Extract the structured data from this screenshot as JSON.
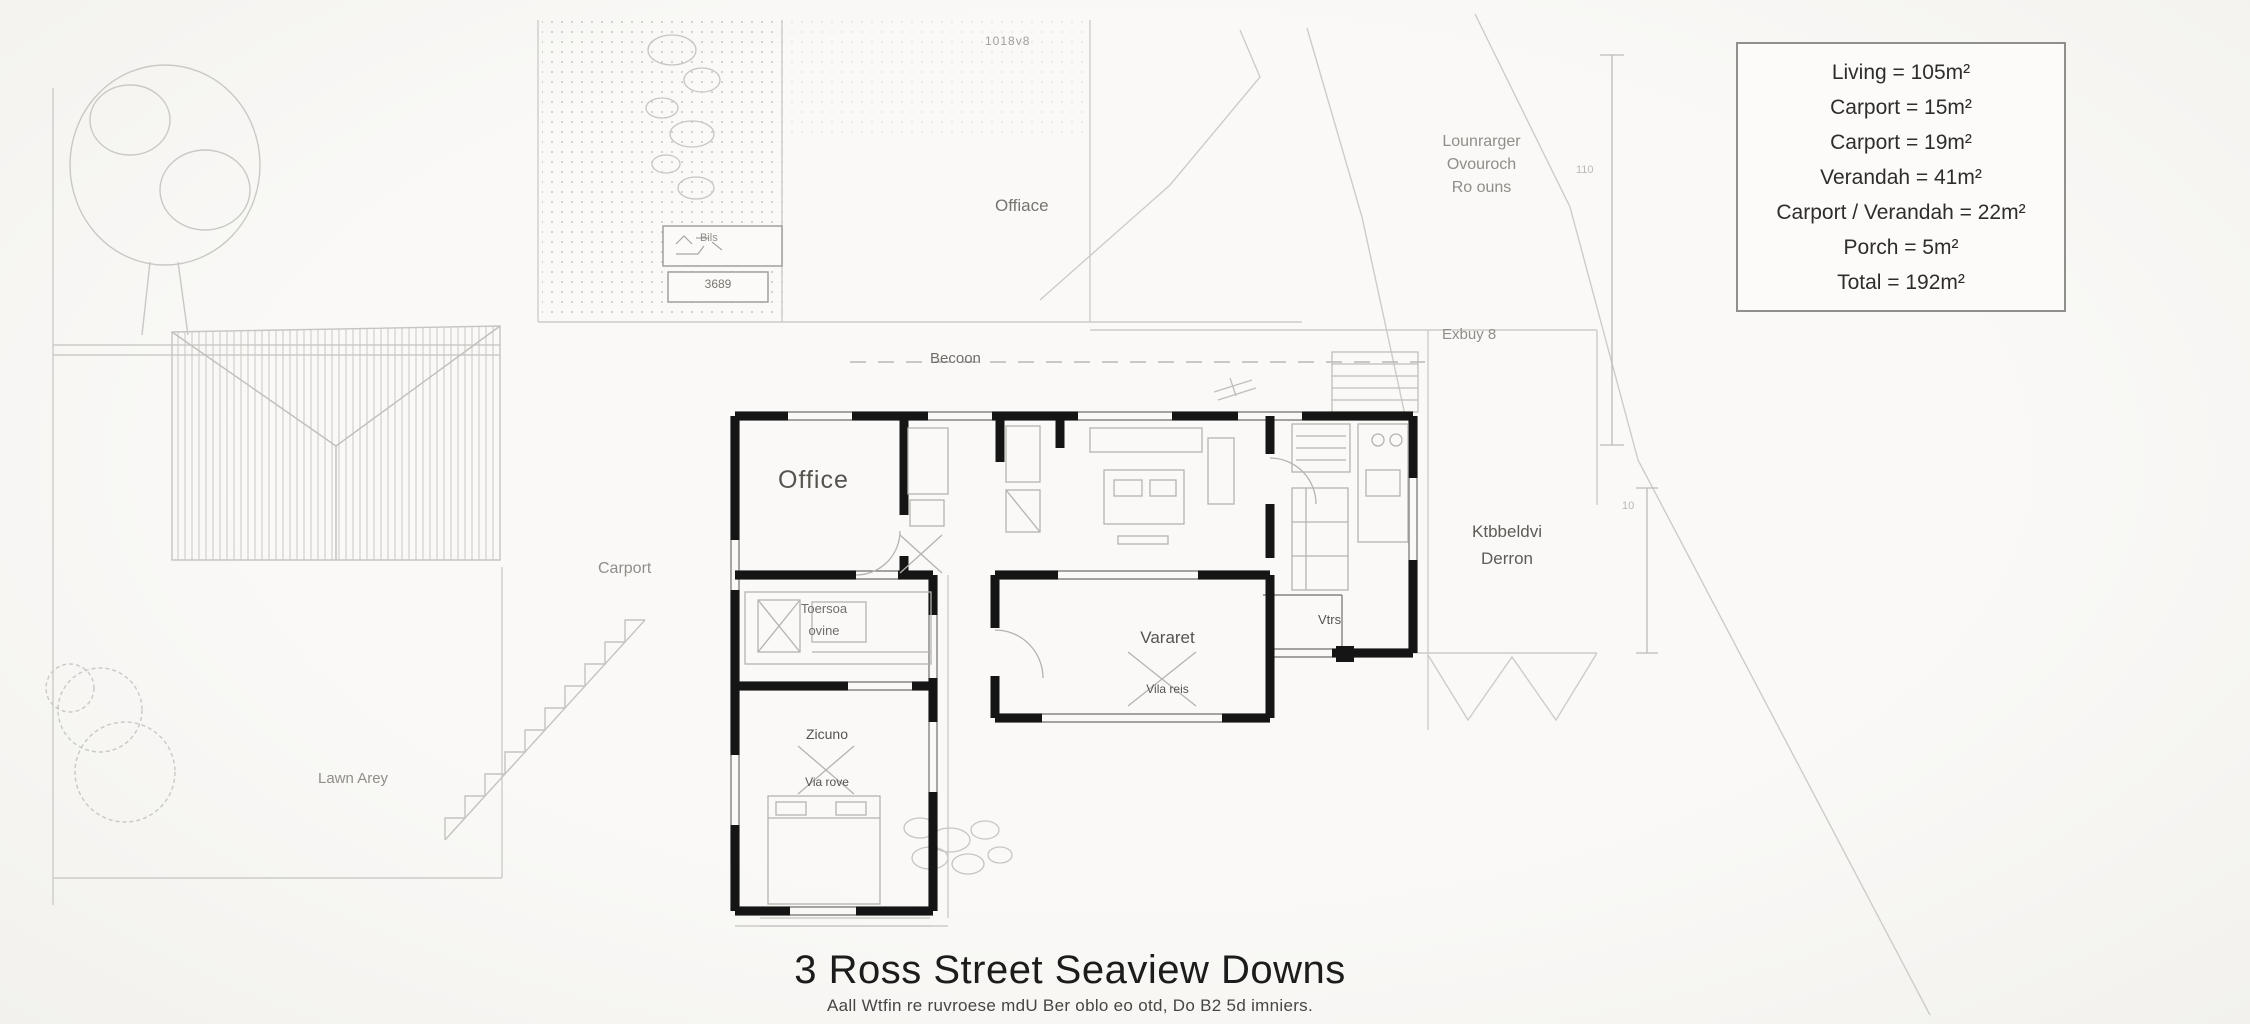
{
  "page": {
    "title": "3 Ross Street Seaview Downs",
    "subtitle": "Aall Wtfin re ruvroese mdU Ber oblo eo otd, Do B2 5d imniers."
  },
  "legend": {
    "lines": [
      "Living = 105m²",
      "Carport = 15m²",
      "Carport = 19m²",
      "Verandah = 41m²",
      "Carport / Verandah = 22m²",
      "Porch = 5m²",
      "Total = 192m²"
    ]
  },
  "site": {
    "gravel_note": "1018v8",
    "office_area": "Offiace",
    "lounge_lines": [
      "Lounrarger",
      "Ovouroch",
      "Ro ouns"
    ],
    "boundary_room": "Becoon",
    "existing": "Exbuy 8",
    "carport": "Carport",
    "lawn": "Lawn Arey",
    "shed_label": "Bils",
    "shed_number": "3689",
    "dim_top": "110",
    "dim_mid": "10"
  },
  "rooms": {
    "office": "Office",
    "laundry_lines": [
      "Toersoa",
      "ovine"
    ],
    "bedroom_lines": [
      "Zicuno",
      "Via rove"
    ],
    "verandah_lines": [
      "Vararet",
      "Vila reis"
    ],
    "wir": "Vtrs",
    "kitchen_lines": [
      "Ktbbeldvi",
      "Derron"
    ]
  }
}
